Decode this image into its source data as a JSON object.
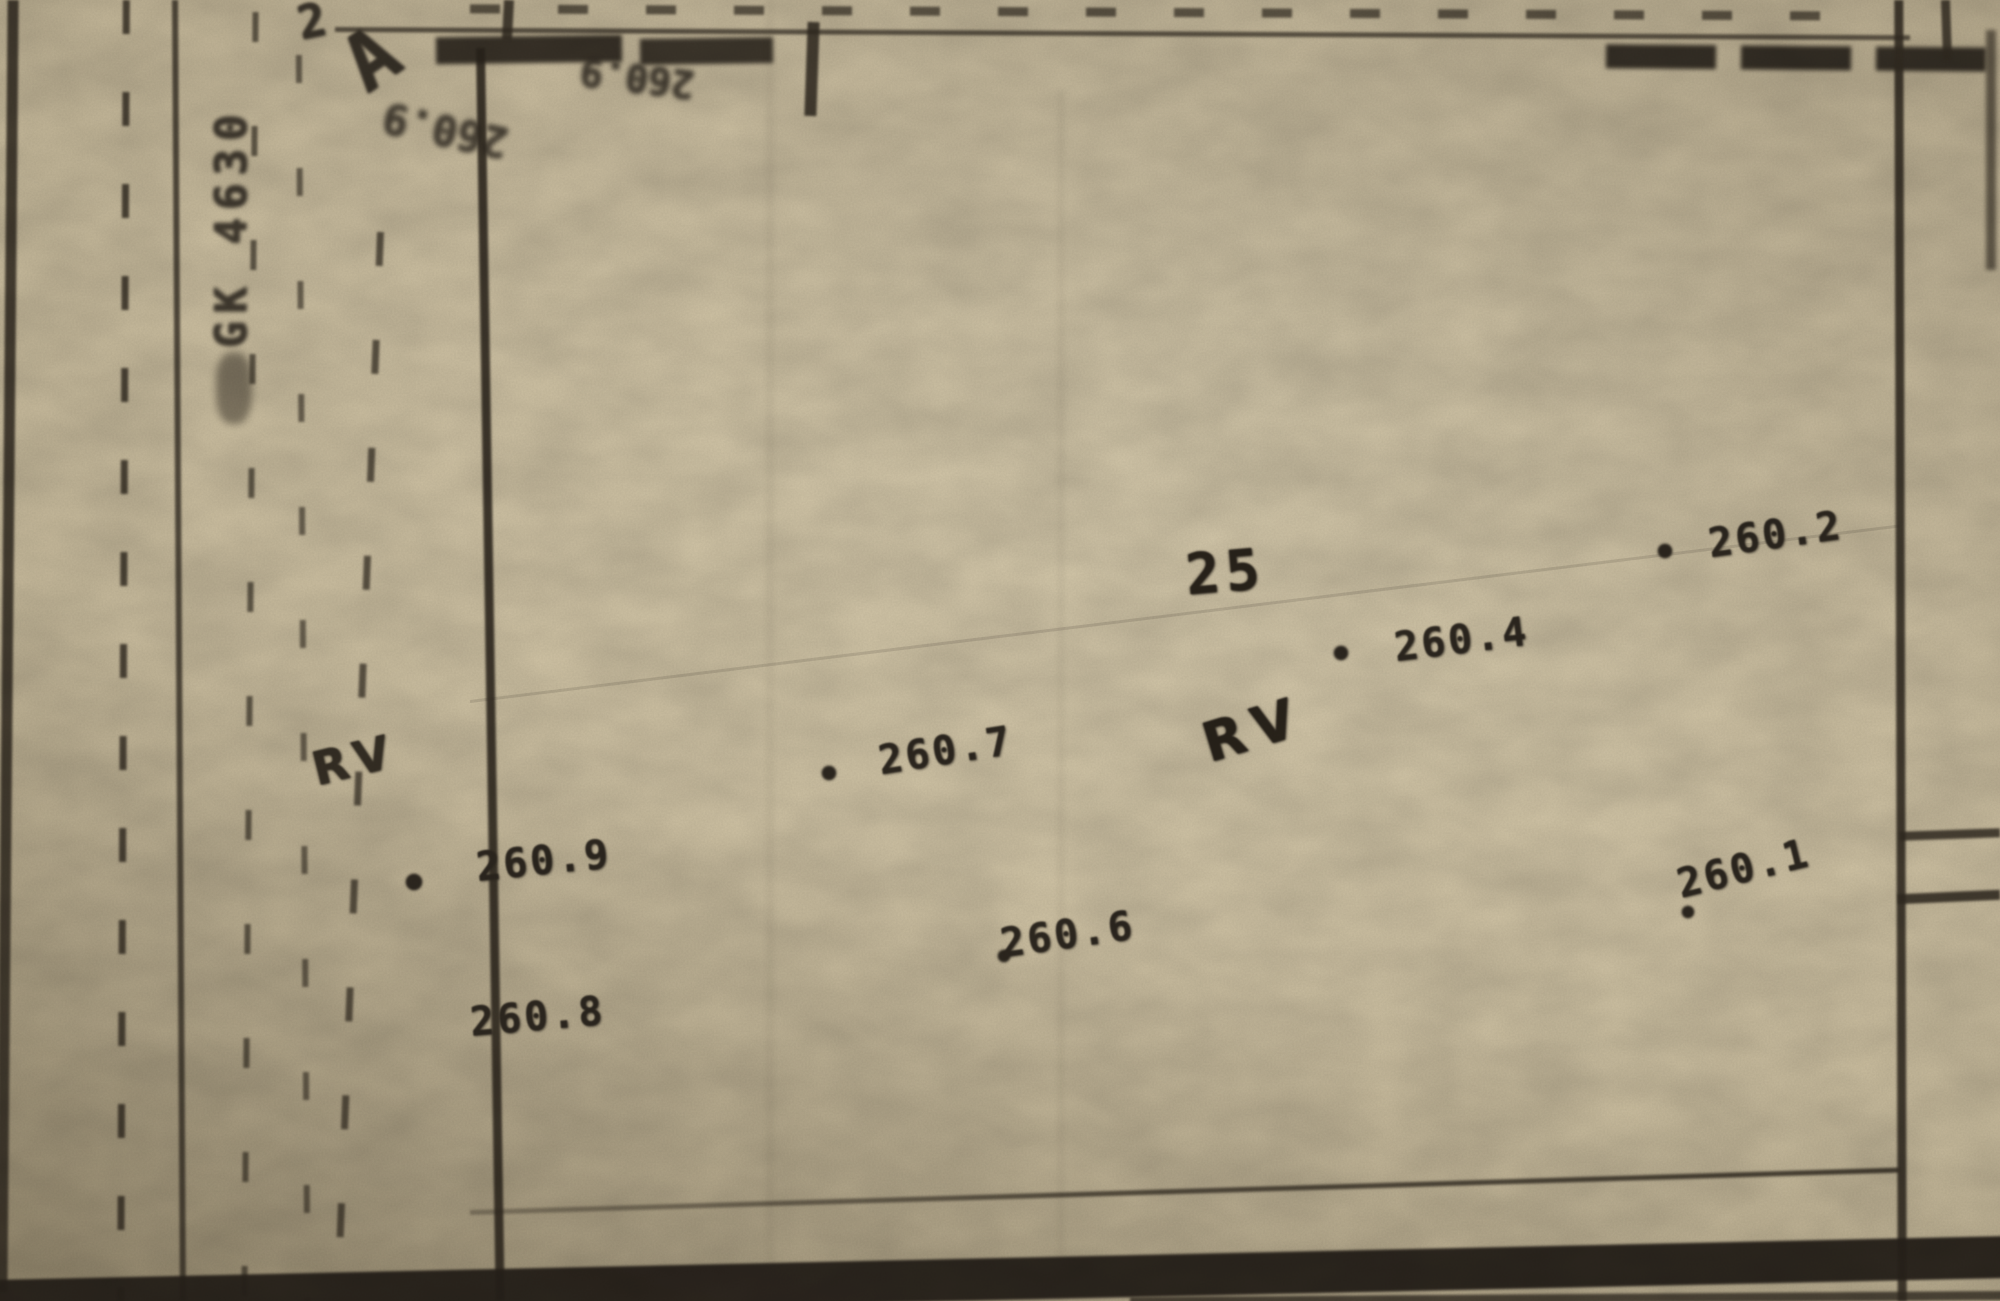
{
  "document": {
    "type": "scanned cadastral survey map photo",
    "paper_color": "#d2c5a6",
    "ink_color": "#2e2820"
  },
  "map": {
    "parcel_number": "25",
    "rv_labels": [
      {
        "text": "RV",
        "position": "parcel-center"
      },
      {
        "text": "RV",
        "position": "left-road"
      }
    ],
    "margin": {
      "letter_a": "A",
      "digit": "2",
      "vertical_text": "GK 4630"
    },
    "smudged_texts": [
      {
        "text": "260.9"
      },
      {
        "text": "260.9"
      }
    ],
    "elevation_points": [
      {
        "label": "260.2",
        "x": 1708,
        "y": 512,
        "rot": -8,
        "dot": {
          "x": 1658,
          "y": 544,
          "r": 7
        }
      },
      {
        "label": "260.4",
        "x": 1394,
        "y": 617,
        "rot": -7,
        "dot": {
          "x": 1334,
          "y": 646,
          "r": 7
        }
      },
      {
        "label": "260.7",
        "x": 878,
        "y": 728,
        "rot": -9,
        "dot": {
          "x": 822,
          "y": 766,
          "r": 7
        }
      },
      {
        "label": "260.9",
        "x": 476,
        "y": 838,
        "rot": -6,
        "dot": {
          "x": 406,
          "y": 874,
          "r": 8
        }
      },
      {
        "label": "260.8",
        "x": 470,
        "y": 994,
        "rot": -5,
        "dot": null
      },
      {
        "label": "260.6",
        "x": 1000,
        "y": 912,
        "rot": -8,
        "dot": {
          "x": 998,
          "y": 950,
          "r": 6
        }
      },
      {
        "label": "260.1",
        "x": 1676,
        "y": 846,
        "rot": -14,
        "dot": {
          "x": 1682,
          "y": 906,
          "r": 6
        }
      }
    ]
  }
}
